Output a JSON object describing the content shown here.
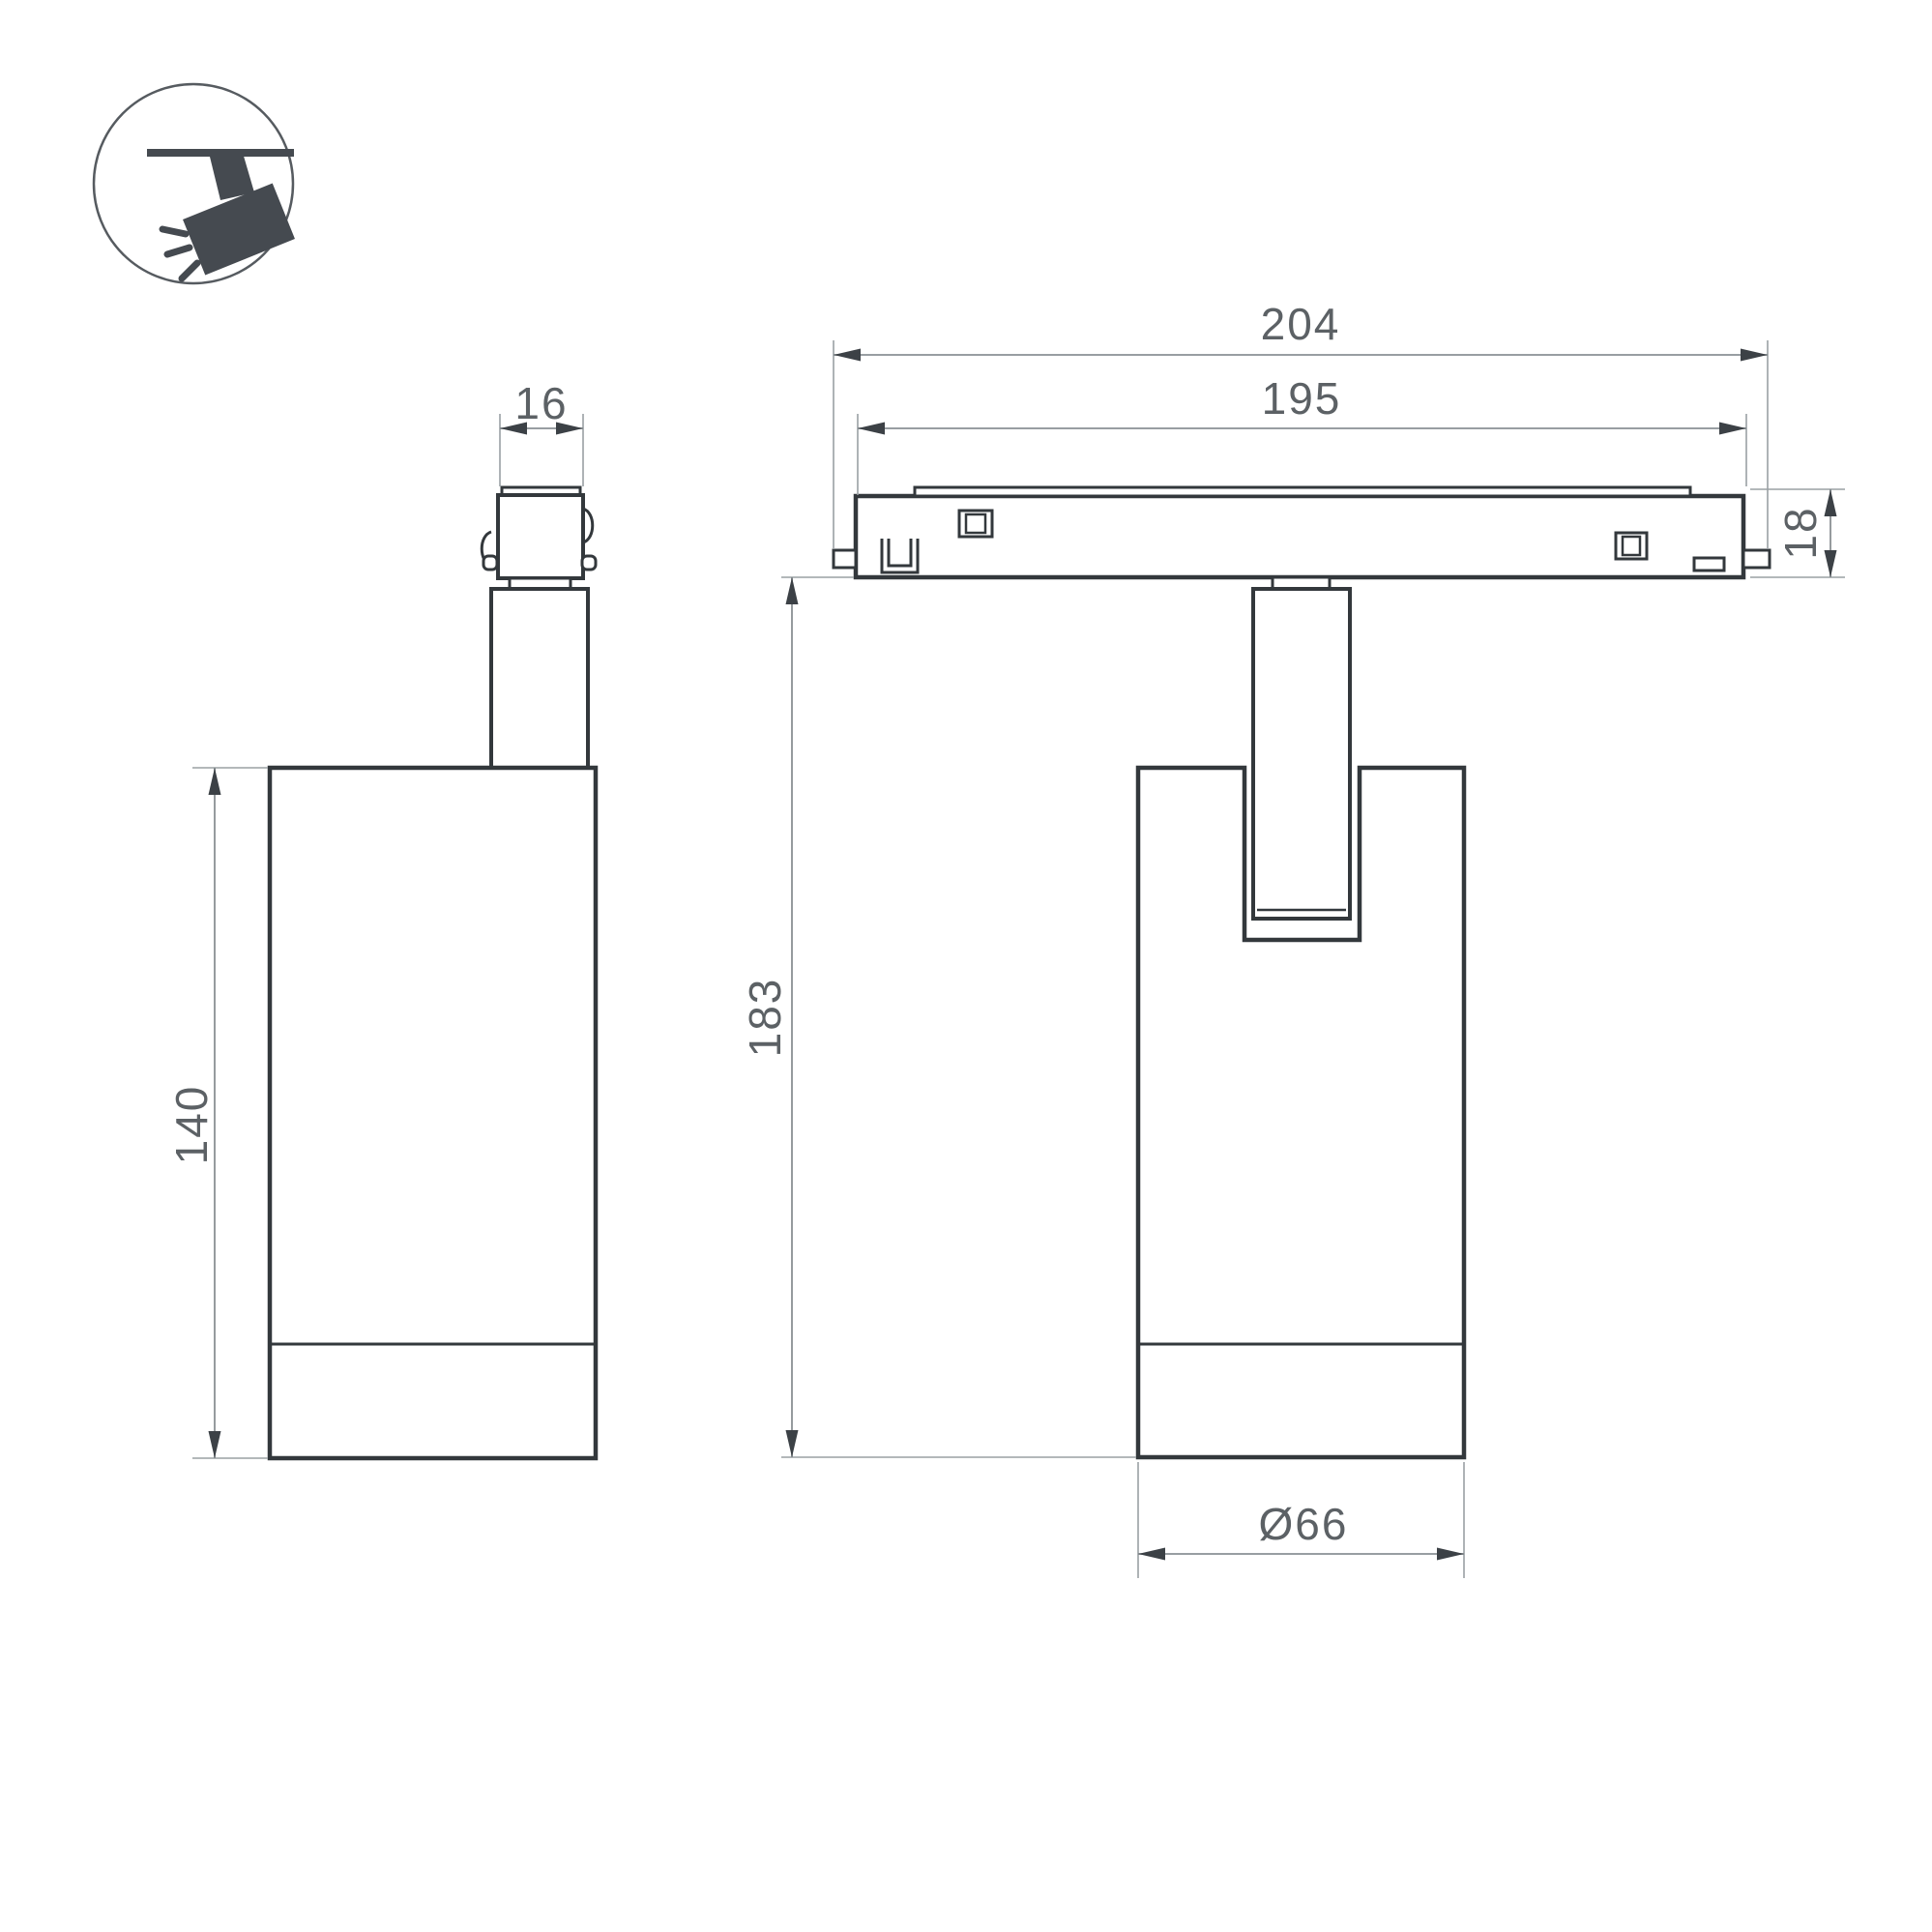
{
  "drawing": {
    "kind": "luminaire-dimension-drawing",
    "dimensions": {
      "connector_width": "16",
      "track_overall_length": "204",
      "track_body_length": "195",
      "track_height": "18",
      "body_height": "140",
      "fixture_height": "183",
      "body_diameter": "Ø66"
    },
    "icon": {
      "name": "track-spotlight-icon",
      "description": "ceiling track with tilted spotlight emitting rays"
    },
    "colors": {
      "outline": "#33383c",
      "dimline": "#8a9094",
      "extline": "#9aa0a4",
      "arrow": "#3c4146",
      "dimtext": "#5c6165",
      "icon": "#454a50",
      "iconring": "#565b60",
      "paper": "#ffffff"
    }
  }
}
